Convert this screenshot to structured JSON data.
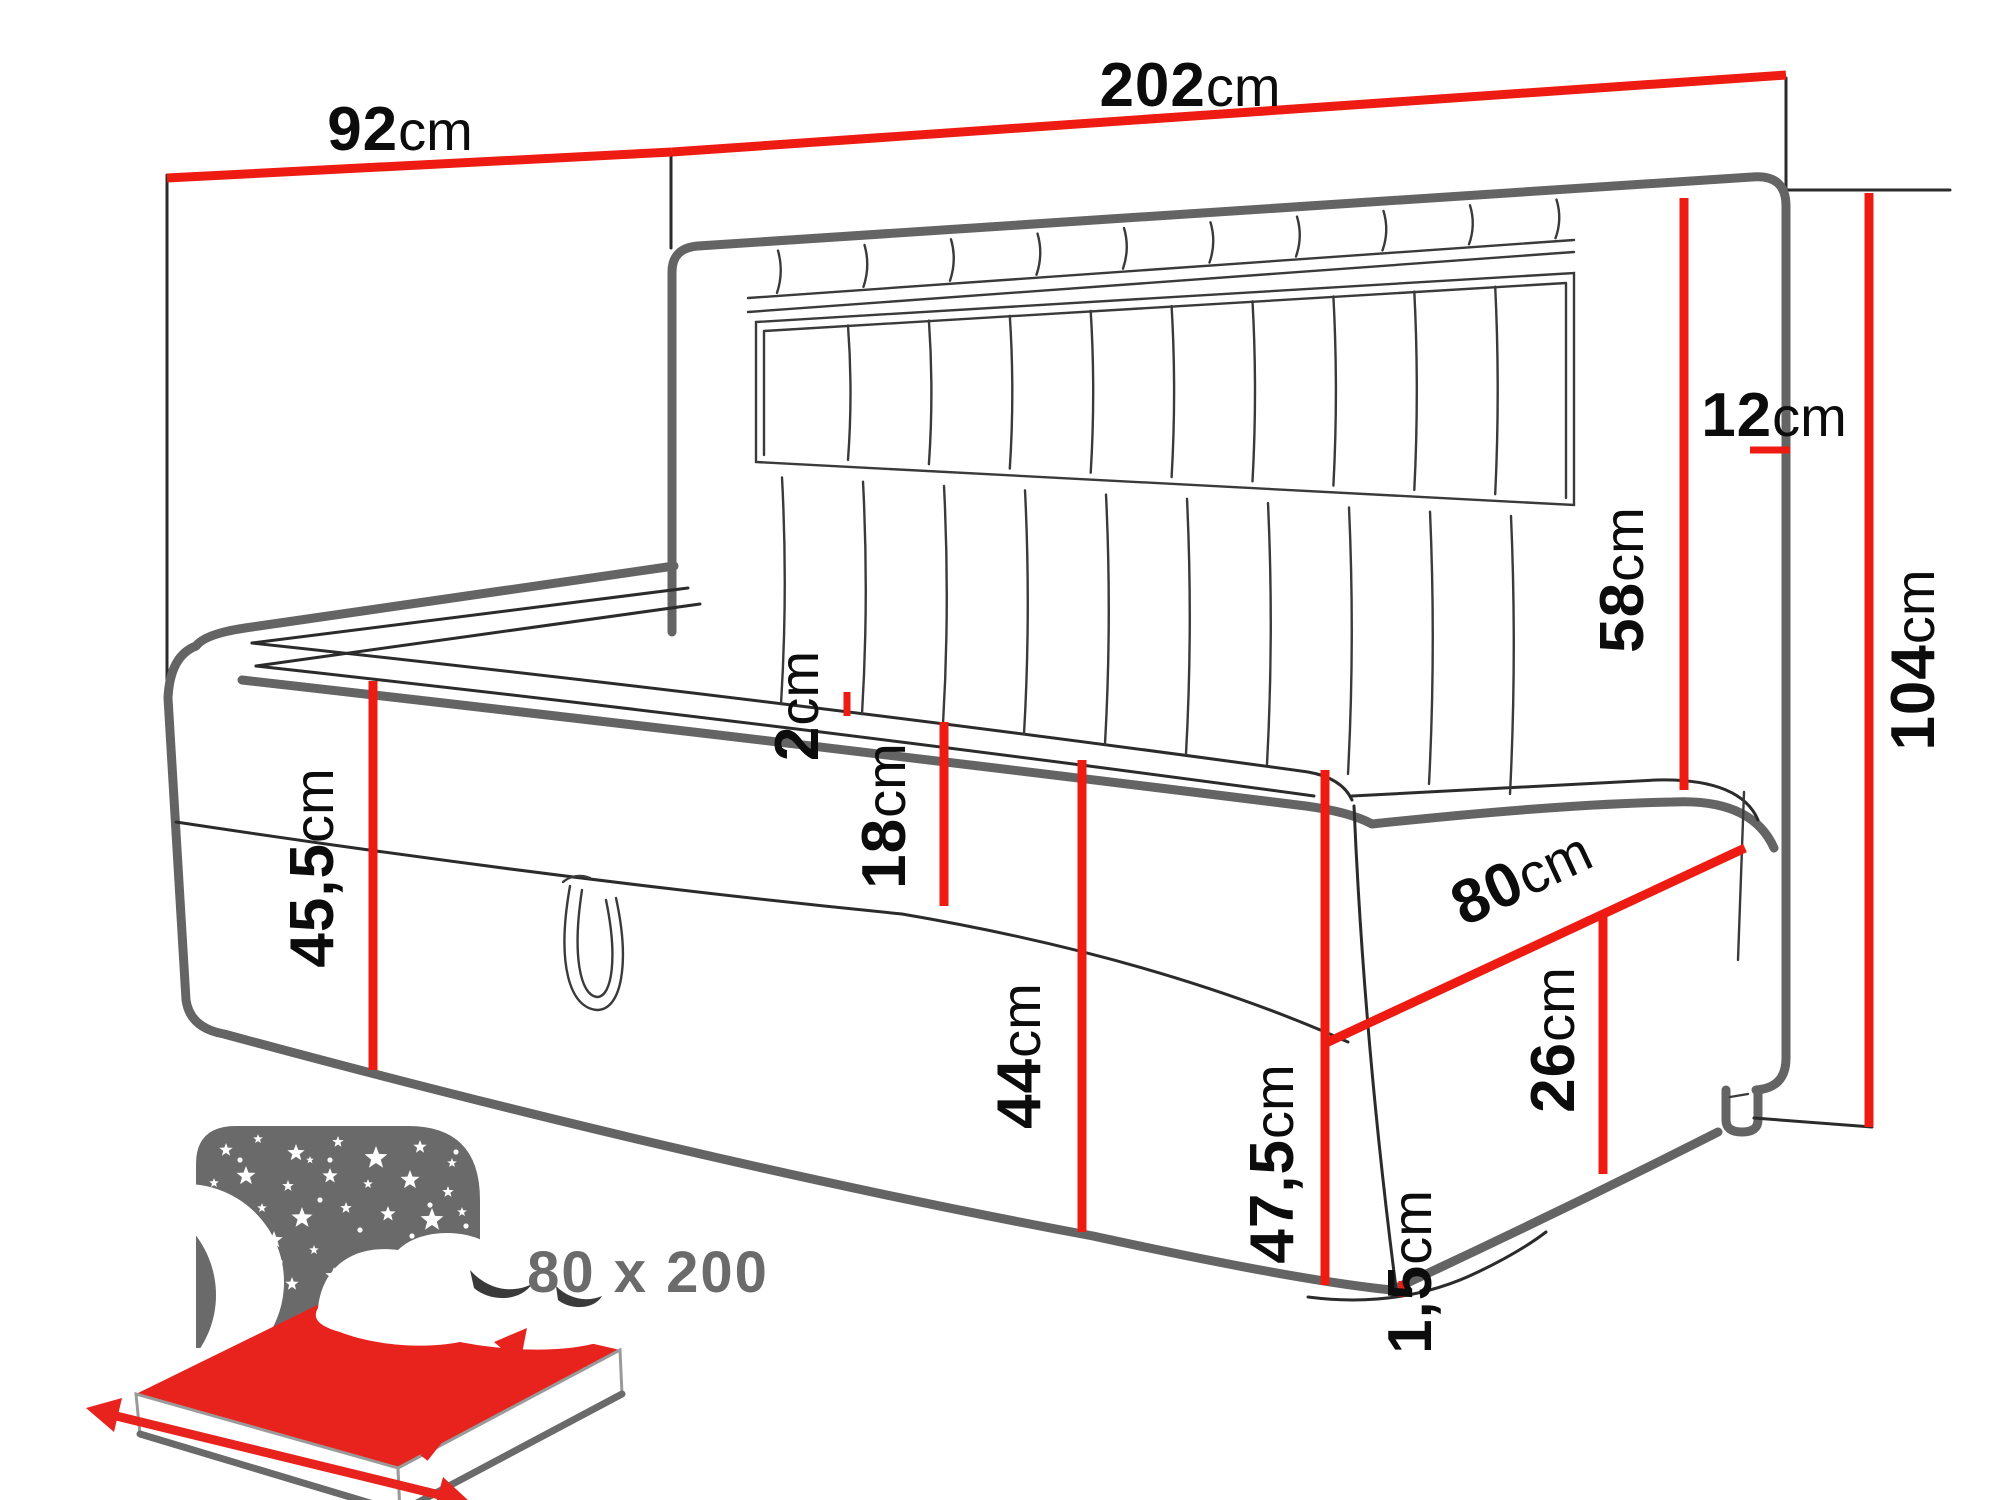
{
  "canvas": {
    "width": 2000,
    "height": 1500
  },
  "colors": {
    "dimension_red": "#ee1b12",
    "outline_gray": "#646464",
    "line_black": "#2b2b2b",
    "icon_gray": "#6a6a6a",
    "icon_red": "#e8231e",
    "label_black": "#0c0c0c"
  },
  "dimensions": {
    "depth": {
      "value": "92",
      "unit": "cm"
    },
    "length": {
      "value": "202",
      "unit": "cm"
    },
    "side_panel": {
      "value": "12",
      "unit": "cm"
    },
    "headboard_height": {
      "value": "58",
      "unit": "cm"
    },
    "total_height": {
      "value": "104",
      "unit": "cm"
    },
    "left_box_height": {
      "value": "45,5",
      "unit": "cm"
    },
    "topper": {
      "value": "2",
      "unit": "cm"
    },
    "upper_box": {
      "value": "18",
      "unit": "cm"
    },
    "storage_height": {
      "value": "44",
      "unit": "cm"
    },
    "front_height": {
      "value": "47,5",
      "unit": "cm"
    },
    "bed_width": {
      "value": "80",
      "unit": "cm"
    },
    "right_storage": {
      "value": "26",
      "unit": "cm"
    },
    "base_gap": {
      "value": "1,5",
      "unit": "cm"
    }
  },
  "badge": {
    "size_label": "80 x 200"
  }
}
